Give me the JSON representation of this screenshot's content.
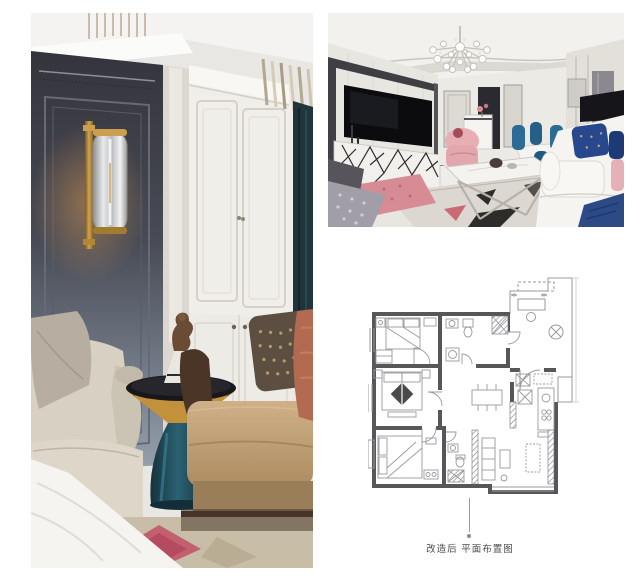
{
  "page": {
    "background": "#ffffff",
    "width": 644,
    "height": 581
  },
  "photos": {
    "left": {
      "label": "interior-detail-photo",
      "palette": {
        "wall_charcoal": "#3c3d45",
        "wall_blue_gray": "#95a0ac",
        "sconce_brass": "#bd8f3e",
        "wardrobe_white": "#f0eee9",
        "curtain_teal": "#203138",
        "armchair_beige": "#d8d1c3",
        "sofa_tan": "#c3a278",
        "pillow_brown": "#5c4f42",
        "pillow_rust": "#b26a50",
        "side_table_brass": "#c2913c",
        "side_table_teal": "#1d4b5a",
        "rug_pink": "#c2556a"
      }
    },
    "top_right": {
      "label": "living-room-photo",
      "palette": {
        "ceiling_white": "#f2f1ee",
        "tv_black": "#101014",
        "sideboard_white": "#f1efeb",
        "sofa_white": "#f5f4f0",
        "pillow_blue": "#27488c",
        "pillow_pink": "#e2a7ae",
        "dining_chair_blue": "#2a6a94",
        "lamp_shade_black": "#1a191d",
        "ottoman_pink": "#d98a94",
        "rug_beige": "#ded9d2"
      }
    }
  },
  "floor_plan": {
    "caption": "改造后 平面布置图",
    "wall_color": "#57575a",
    "furniture_line_color": "#9a9a9c",
    "caption_color": "#4a4a4a"
  }
}
